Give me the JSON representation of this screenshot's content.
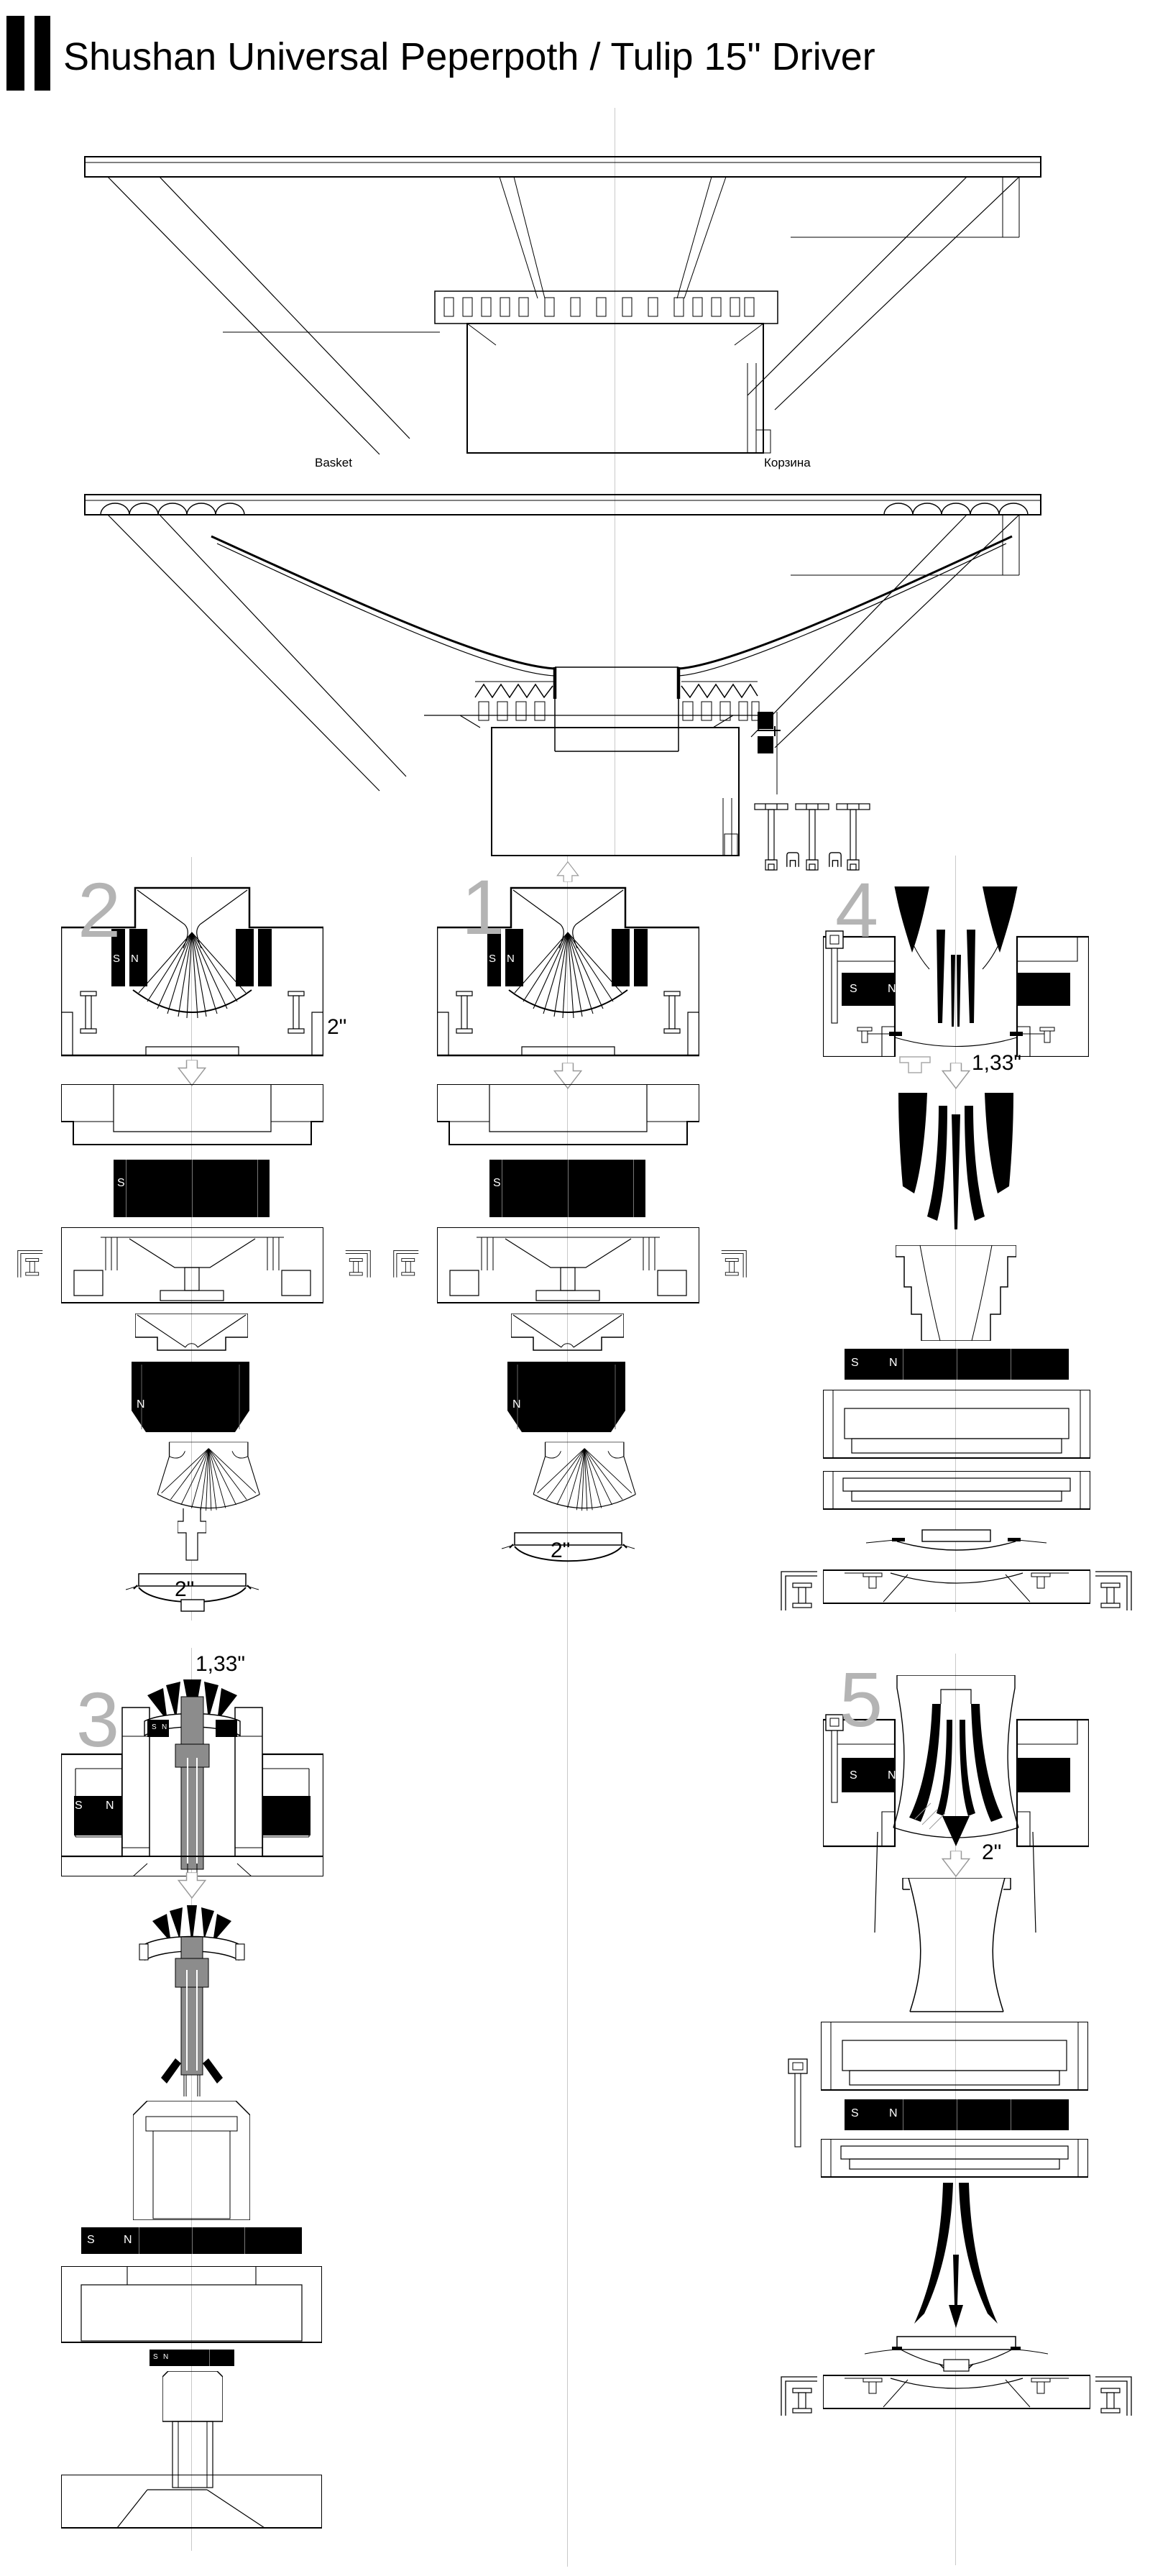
{
  "header": {
    "title": "Shushan Universal Peperpoth / Tulip 15\" Driver"
  },
  "basket_view": {
    "label_en": "Basket",
    "label_ru": "Корзина"
  },
  "magnet": {
    "south": "S",
    "north": "N"
  },
  "groups": {
    "g1": {
      "number": "1",
      "dome_dim": "2\""
    },
    "g2": {
      "number": "2",
      "assembled_dim": "2\"",
      "dome_dim": "2\""
    },
    "g3": {
      "number": "3",
      "assembled_dim": "1,33\""
    },
    "g4": {
      "number": "4",
      "assembled_dim": "1,33\""
    },
    "g5": {
      "number": "5",
      "assembled_dim": "2\""
    }
  },
  "colors": {
    "line": "#000000",
    "magnet": "#000000",
    "number_gray": "#b4b4b4",
    "arrow_gray": "#999999",
    "centerline_gray": "#c9c9c9",
    "shaft_gray": "#8c8c8c"
  }
}
